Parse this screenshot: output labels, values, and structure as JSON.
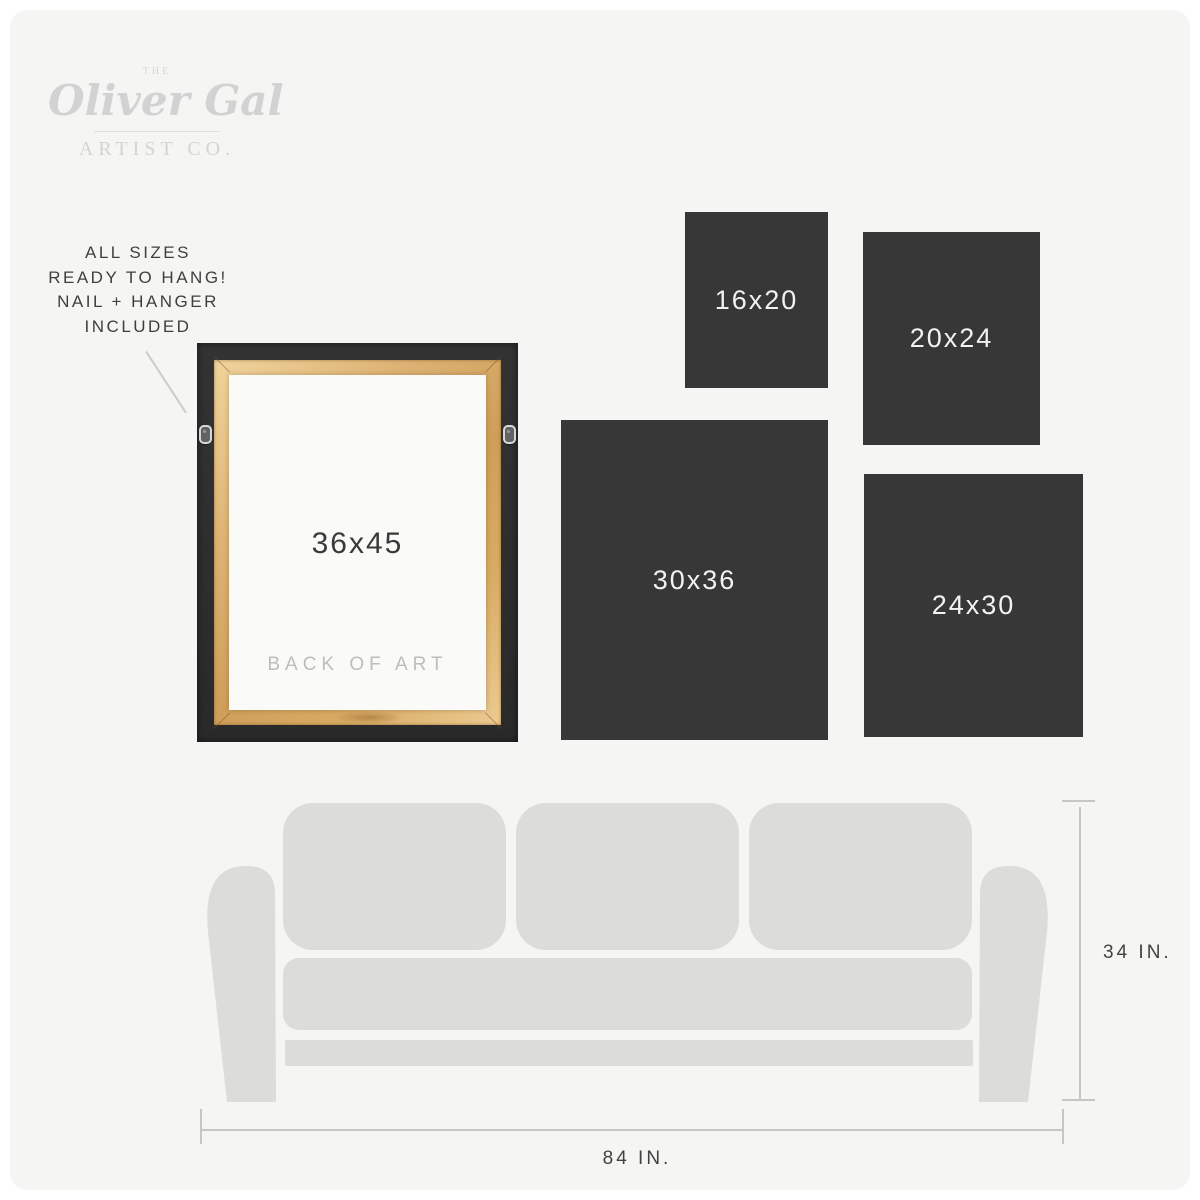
{
  "brand": {
    "the": "THE",
    "name": "Oliver Gal",
    "subtitle": "ARTIST CO."
  },
  "hang_note": {
    "lines": [
      "ALL SIZES",
      "READY TO HANG!",
      "NAIL + HANGER",
      "INCLUDED"
    ]
  },
  "featured": {
    "size_label": "36x45",
    "caption": "BACK OF ART"
  },
  "size_boxes": [
    {
      "label": "16x20"
    },
    {
      "label": "20x24"
    },
    {
      "label": "30x36"
    },
    {
      "label": "24x30"
    }
  ],
  "sofa_measurements": {
    "height_label": "34 IN.",
    "width_label": "84 IN."
  },
  "colors": {
    "page_background": "#f5f5f3",
    "size_box": "#373737",
    "size_box_text": "#f2f2f2",
    "sofa": "#dcdcdb",
    "frame_black": "#2e2e2e",
    "frame_wood": "#d8ab63",
    "canvas_back": "#fafaf8",
    "logo_gray": "#d2d2d2",
    "text_dark": "#3f3f3f",
    "caption_gray": "#bdbdbd",
    "measure_line": "#c6c6c4"
  }
}
